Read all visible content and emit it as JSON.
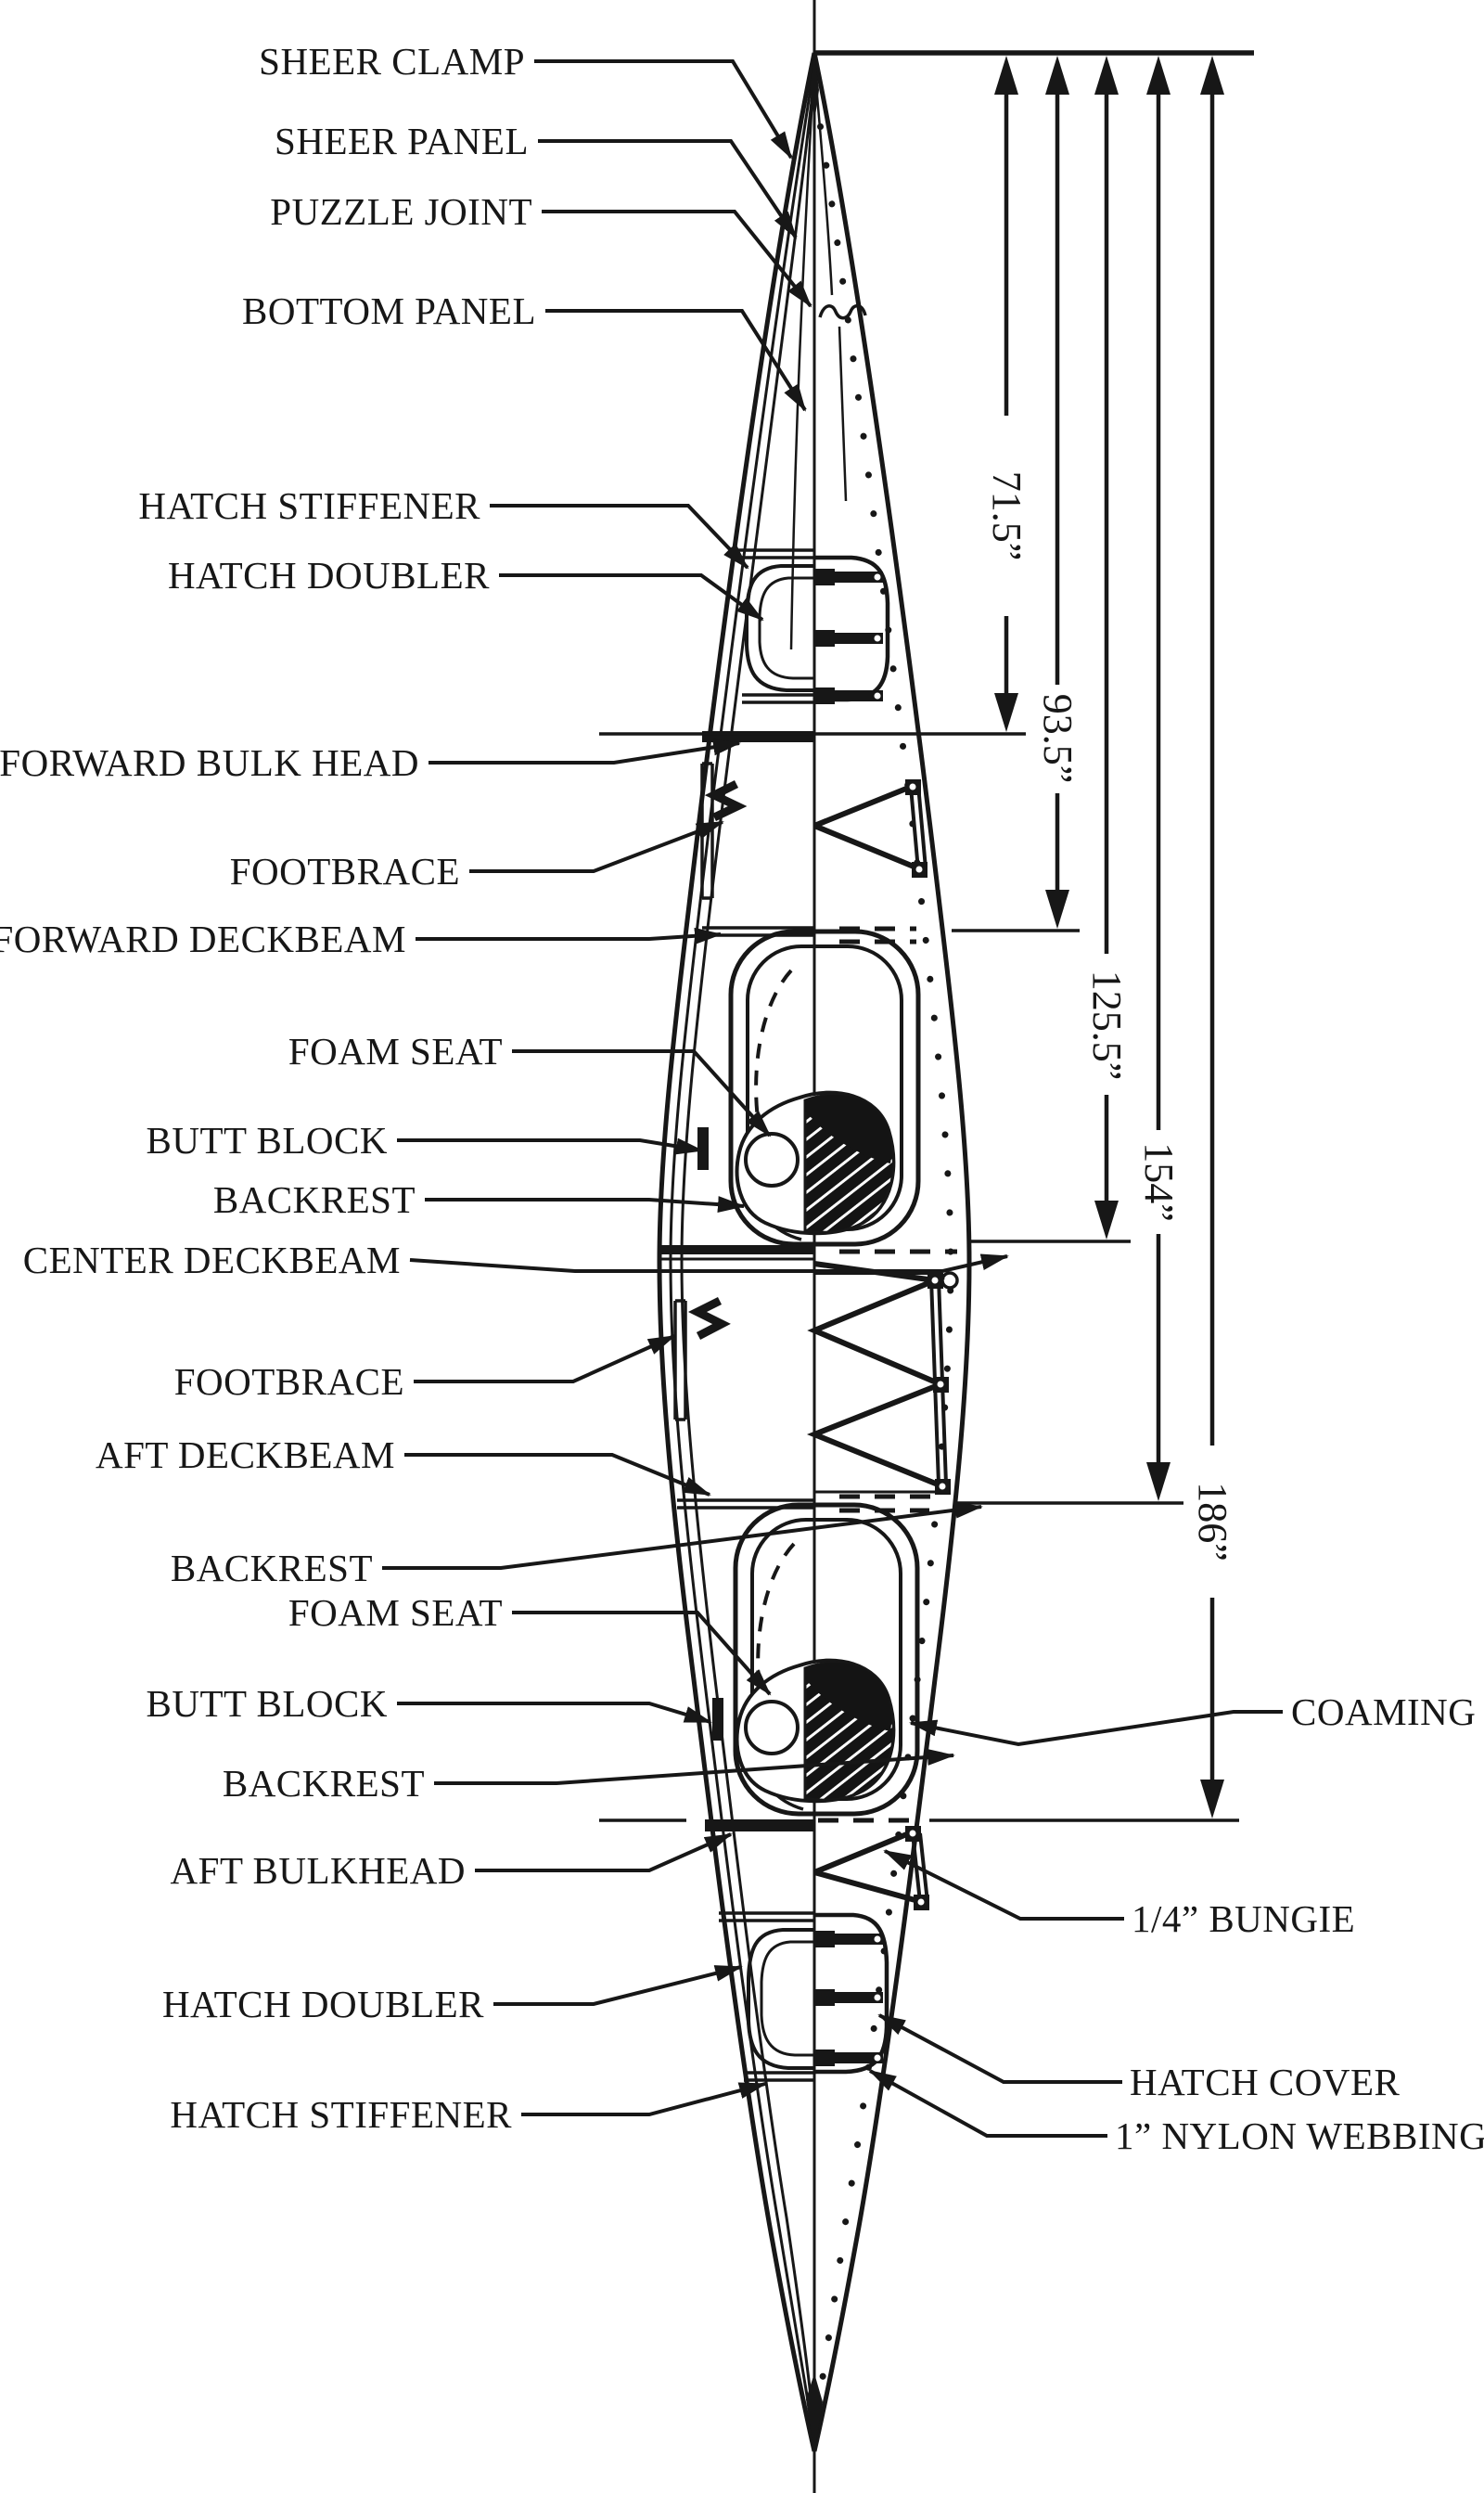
{
  "meta": {
    "description": "Tandem kayak construction plan, top view, bow at top",
    "ink_color": "#171717",
    "background_color": "#ffffff"
  },
  "labels": {
    "sheer_clamp": "SHEER CLAMP",
    "sheer_panel": "SHEER PANEL",
    "puzzle_joint": "PUZZLE JOINT",
    "bottom_panel": "BOTTOM PANEL",
    "hatch_stiffener_fwd": "HATCH STIFFENER",
    "hatch_doubler_fwd": "HATCH DOUBLER",
    "forward_bulk_head": "FORWARD BULK HEAD",
    "footbrace_fwd": "FOOTBRACE",
    "forward_deckbeam": "FORWARD DECKBEAM",
    "foam_seat_fwd": "FOAM SEAT",
    "butt_block_fwd": "BUTT BLOCK",
    "backrest_fwd": "BACKREST",
    "center_deckbeam": "CENTER DECKBEAM",
    "footbrace_aft": "FOOTBRACE",
    "aft_deckbeam": "AFT DECKBEAM",
    "backrest_mid": "BACKREST",
    "foam_seat_aft": "FOAM SEAT",
    "butt_block_aft": "BUTT BLOCK",
    "backrest_aft": "BACKREST",
    "aft_bulkhead": "AFT BULKHEAD",
    "hatch_doubler_aft": "HATCH DOUBLER",
    "hatch_stiffener_aft": "HATCH STIFFENER",
    "coaming": "COAMING",
    "quarter_bungie": "1/4” BUNGIE",
    "hatch_cover": "HATCH COVER",
    "nylon_webbing": "1” NYLON WEBBING"
  },
  "dimensions": {
    "station_1": "71.5”",
    "station_2": "93.5”",
    "station_3": "125.5”",
    "station_4": "154”",
    "station_5": "186”"
  }
}
